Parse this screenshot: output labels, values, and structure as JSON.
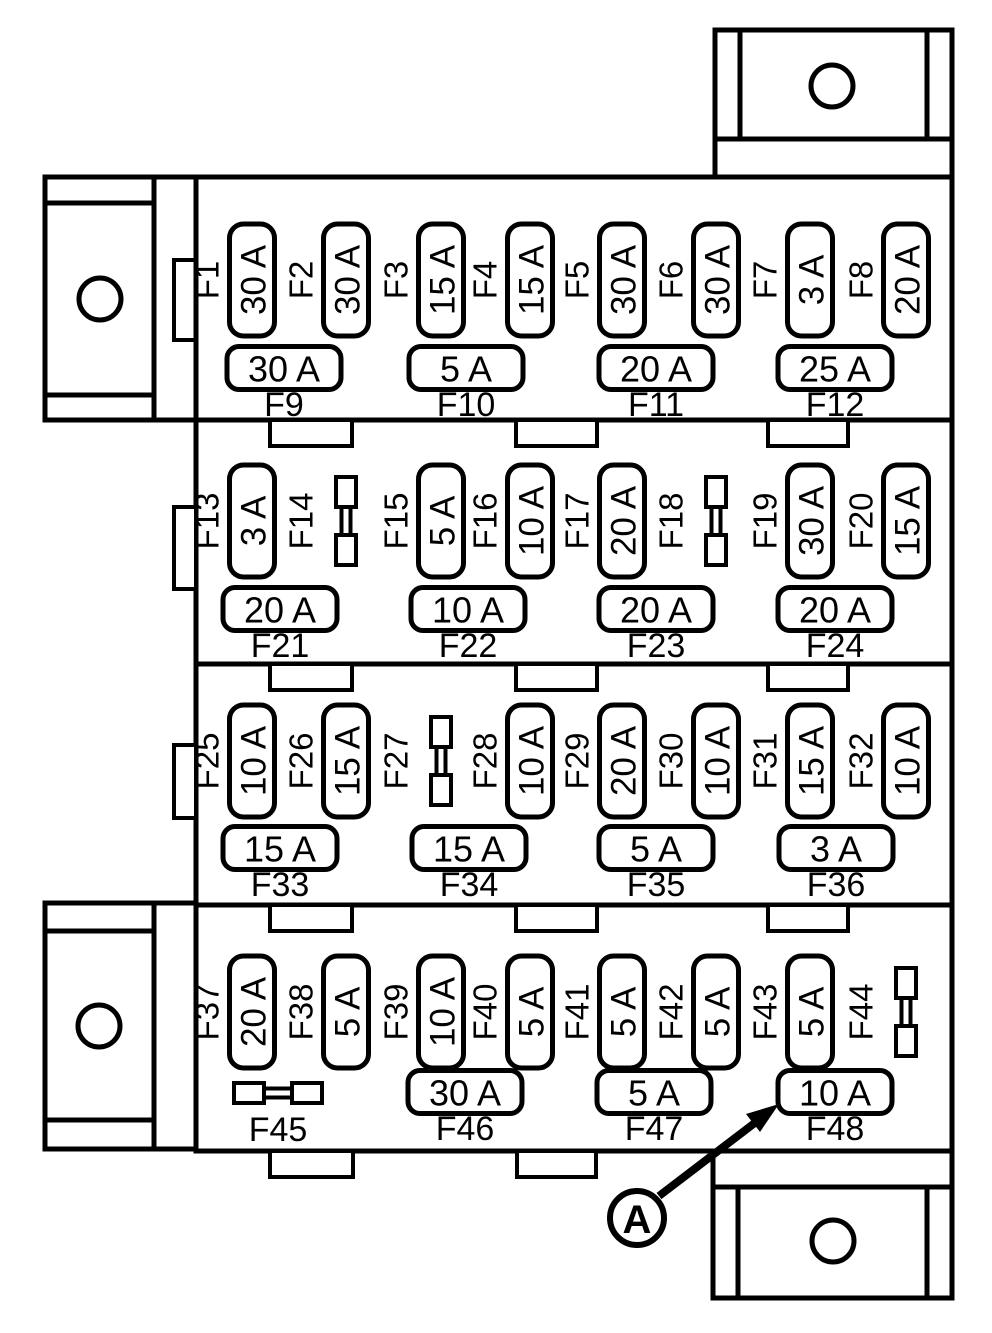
{
  "diagram": {
    "type": "fuse-box",
    "callout": {
      "label": "A",
      "points_to": "F48"
    },
    "rows": [
      {
        "vertical_fuses": [
          {
            "id": "F1",
            "amp": "30 A"
          },
          {
            "id": "F2",
            "amp": "30 A"
          },
          {
            "id": "F3",
            "amp": "15 A"
          },
          {
            "id": "F4",
            "amp": "15 A"
          },
          {
            "id": "F5",
            "amp": "30 A"
          },
          {
            "id": "F6",
            "amp": "30 A"
          },
          {
            "id": "F7",
            "amp": "3 A"
          },
          {
            "id": "F8",
            "amp": "20 A"
          }
        ],
        "horizontal_fuses": [
          {
            "id": "F9",
            "amp": "30 A"
          },
          {
            "id": "F10",
            "amp": "5 A"
          },
          {
            "id": "F11",
            "amp": "20 A"
          },
          {
            "id": "F12",
            "amp": "25 A"
          }
        ]
      },
      {
        "vertical_fuses": [
          {
            "id": "F13",
            "amp": "3 A"
          },
          {
            "id": "F14",
            "amp": null,
            "symbol": "fuse-link-icon"
          },
          {
            "id": "F15",
            "amp": "5 A"
          },
          {
            "id": "F16",
            "amp": "10 A"
          },
          {
            "id": "F17",
            "amp": "20 A"
          },
          {
            "id": "F18",
            "amp": null,
            "symbol": "fuse-link-icon"
          },
          {
            "id": "F19",
            "amp": "30 A"
          },
          {
            "id": "F20",
            "amp": "15 A"
          }
        ],
        "horizontal_fuses": [
          {
            "id": "F21",
            "amp": "20 A"
          },
          {
            "id": "F22",
            "amp": "10 A"
          },
          {
            "id": "F23",
            "amp": "20 A"
          },
          {
            "id": "F24",
            "amp": "20 A"
          }
        ]
      },
      {
        "vertical_fuses": [
          {
            "id": "F25",
            "amp": "10 A"
          },
          {
            "id": "F26",
            "amp": "15 A"
          },
          {
            "id": "F27",
            "amp": null,
            "symbol": "fuse-link-icon"
          },
          {
            "id": "F28",
            "amp": "10 A"
          },
          {
            "id": "F29",
            "amp": "20 A"
          },
          {
            "id": "F30",
            "amp": "10 A"
          },
          {
            "id": "F31",
            "amp": "15 A"
          },
          {
            "id": "F32",
            "amp": "10 A"
          }
        ],
        "horizontal_fuses": [
          {
            "id": "F33",
            "amp": "15 A"
          },
          {
            "id": "F34",
            "amp": "15 A"
          },
          {
            "id": "F35",
            "amp": "5 A"
          },
          {
            "id": "F36",
            "amp": "3 A"
          }
        ]
      },
      {
        "vertical_fuses": [
          {
            "id": "F37",
            "amp": "20 A"
          },
          {
            "id": "F38",
            "amp": "5 A"
          },
          {
            "id": "F39",
            "amp": "10 A"
          },
          {
            "id": "F40",
            "amp": "5 A"
          },
          {
            "id": "F41",
            "amp": "5 A"
          },
          {
            "id": "F42",
            "amp": "5 A"
          },
          {
            "id": "F43",
            "amp": "5 A"
          },
          {
            "id": "F44",
            "amp": null,
            "symbol": "fuse-link-icon"
          }
        ],
        "horizontal_fuses": [
          {
            "id": "F45",
            "amp": null,
            "symbol": "fuse-link-icon"
          },
          {
            "id": "F46",
            "amp": "30 A"
          },
          {
            "id": "F47",
            "amp": "5 A"
          },
          {
            "id": "F48",
            "amp": "10 A"
          }
        ]
      }
    ]
  }
}
